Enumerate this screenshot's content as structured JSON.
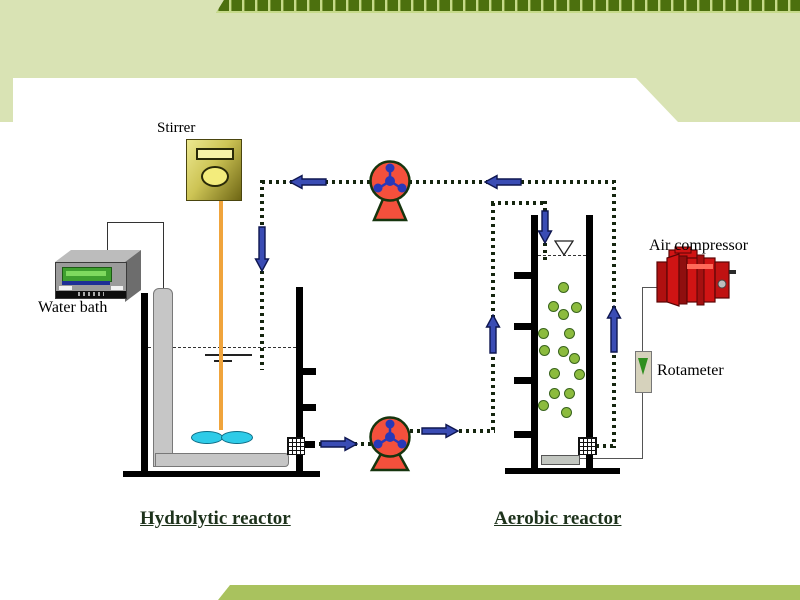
{
  "labels": {
    "stirrer": "Stirrer",
    "water_bath": "Water bath",
    "air_compressor": "Air compressor",
    "rotameter": "Rotameter",
    "hydrolytic_reactor": "Hydrolytic reactor",
    "aerobic_reactor": "Aerobic reactor"
  },
  "diagram": {
    "components": [
      {
        "id": "water-bath",
        "label": "Water bath"
      },
      {
        "id": "stirrer",
        "label": "Stirrer"
      },
      {
        "id": "hydrolytic-reactor",
        "label": "Hydrolytic reactor"
      },
      {
        "id": "recirculation-pump-top",
        "label": ""
      },
      {
        "id": "transfer-pump-bottom",
        "label": ""
      },
      {
        "id": "aerobic-reactor",
        "label": "Aerobic reactor"
      },
      {
        "id": "air-compressor",
        "label": "Air compressor"
      },
      {
        "id": "rotameter",
        "label": "Rotameter"
      }
    ],
    "flows": [
      "aerobic reactor bottom valve -> up -> left via top pump -> down into hydrolytic reactor",
      "hydrolytic reactor bottom valve -> right via bottom pump -> up -> down into aerobic reactor top",
      "air compressor -> rotameter -> sparger at aerobic reactor bottom"
    ]
  },
  "colors": {
    "background_green": "#d9e3b4",
    "footer_band_green": "#a9c25e",
    "header_strip_green": "#4c700e",
    "header_strip_tick": "#c6da8a",
    "pipe_dot_dark": "#15250f",
    "flow_arrow_blue": "#3a4cb4",
    "pump_red": "#f4503c",
    "compressor_red": "#d01414",
    "bubble_green": "#8cbb3e",
    "propeller_cyan": "#2ecbe8",
    "stirrer_rod_orange": "#f0a43c"
  }
}
